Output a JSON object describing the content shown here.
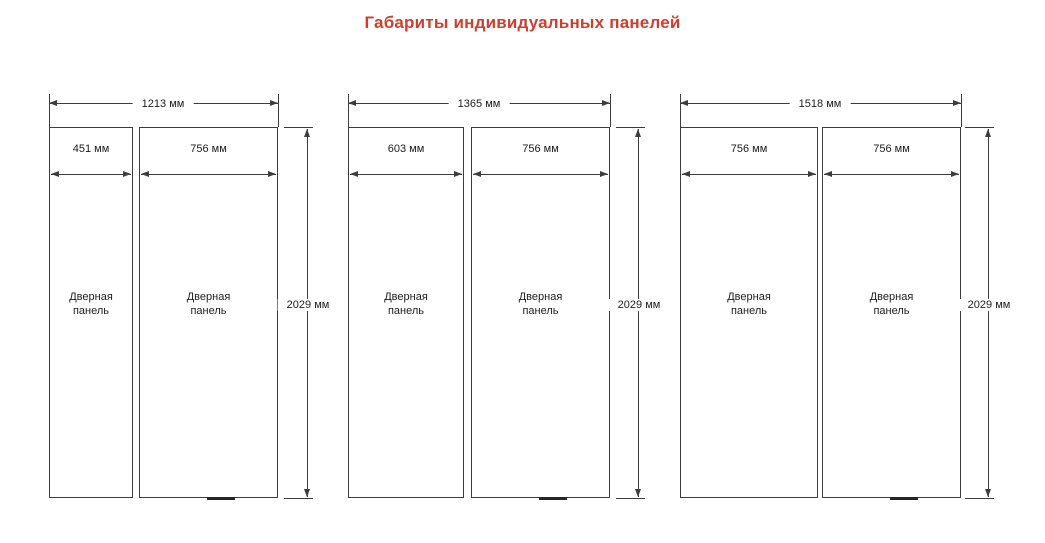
{
  "title": "Габариты индивидуальных панелей",
  "colors": {
    "title_accent": "#cf3e2c",
    "line": "#3d3d3d"
  },
  "labels": {
    "panel_name": "Дверная панель"
  },
  "groups": [
    {
      "total_width": "1213 мм",
      "left_width": "451 мм",
      "right_width": "756 мм",
      "height": "2029 мм"
    },
    {
      "total_width": "1365 мм",
      "left_width": "603 мм",
      "right_width": "756 мм",
      "height": "2029 мм"
    },
    {
      "total_width": "1518 мм",
      "left_width": "756 мм",
      "right_width": "756 мм",
      "height": "2029 мм"
    }
  ]
}
